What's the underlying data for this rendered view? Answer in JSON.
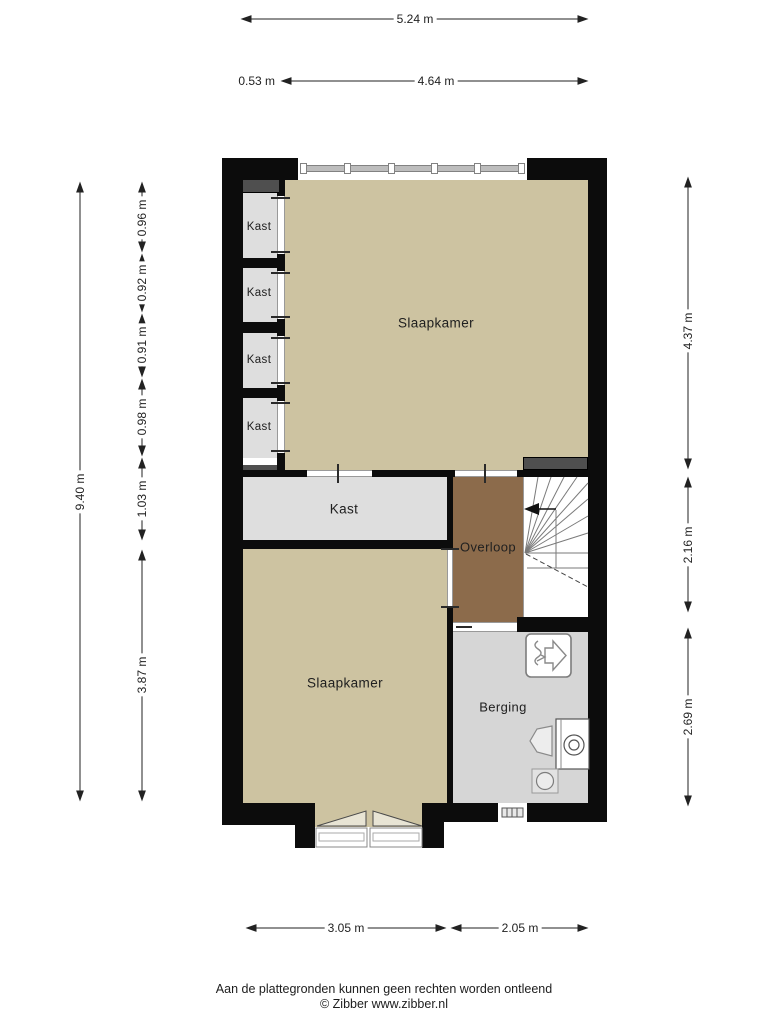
{
  "plan": {
    "rooms": {
      "kast1": "Kast",
      "kast2": "Kast",
      "kast3": "Kast",
      "kast4": "Kast",
      "slaapkamer_top": "Slaapkamer",
      "kast_middle": "Kast",
      "overloop": "Overloop",
      "slaapkamer_bottom": "Slaapkamer",
      "berging": "Berging"
    },
    "dimensions": {
      "top_total": "5.24 m",
      "top_offset": "0.53 m",
      "top_inner": "4.64 m",
      "left_total": "9.40 m",
      "left_segments": [
        "0.96 m",
        "0.92 m",
        "0.91 m",
        "0.98 m",
        "1.03 m",
        "3.87 m"
      ],
      "right_segments": [
        "4.37 m",
        "2.16 m",
        "2.69 m"
      ],
      "bottom_segments": [
        "3.05 m",
        "2.05 m"
      ]
    },
    "icons": {
      "stairs": "stairs-with-direction-arrow",
      "ventilation": "mechanical-ventilation-unit",
      "washer": "washing-machine",
      "sink": "utility-sink",
      "drain": "floor-drain",
      "doors": "double-garden-doors"
    }
  },
  "colors": {
    "floor-beige": "#cdc3a1",
    "floor-gray": "#dedede",
    "floor-gray-dark": "#d6d6d6",
    "floor-brown": "#8c6b4b",
    "wall": "#0c0c0c",
    "beam": "#4f4f4f",
    "dim": "#222222"
  },
  "footer": {
    "disclaimer": "Aan de plattegronden kunnen geen rechten worden ontleend",
    "copyright": "© Zibber www.zibber.nl"
  }
}
